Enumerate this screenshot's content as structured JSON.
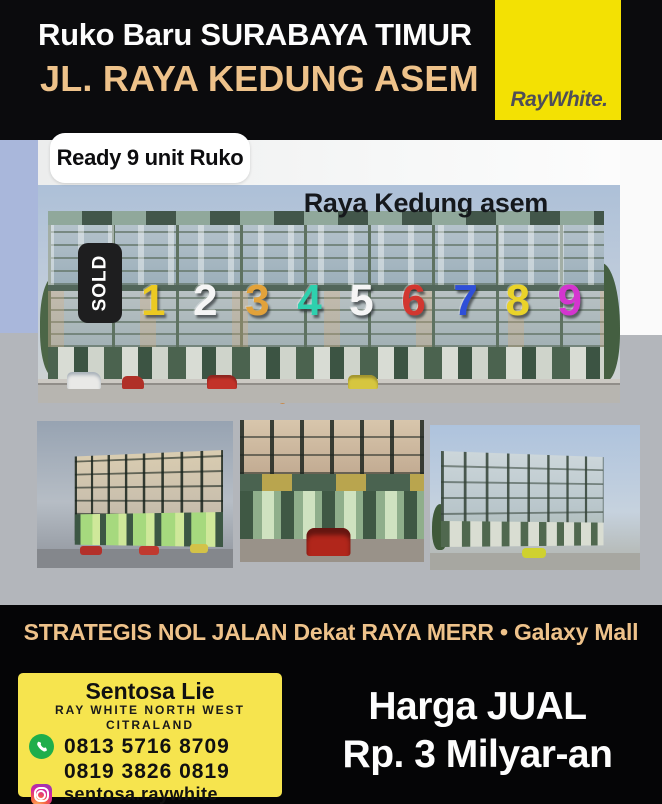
{
  "colors": {
    "accent_tan": "#eec28a",
    "brand_yellow": "#f3e103",
    "logo_text": "#4e4e58",
    "card_yellow": "#f6e44e",
    "whatsapp_green": "#1fae4b"
  },
  "header": {
    "title_line1": "Ruko Baru SURABAYA TIMUR",
    "title_line2": "JL. RAYA KEDUNG ASEM",
    "brand": "RayWhite."
  },
  "listing": {
    "ready_badge": "Ready 9 unit Ruko",
    "street_label": "Raya Kedung asem",
    "sold_badge": "SOLD",
    "unit_numbers": [
      {
        "label": "1",
        "color": "#ecca22"
      },
      {
        "label": "2",
        "color": "#f5f5f5"
      },
      {
        "label": "3",
        "color": "#e2a23a"
      },
      {
        "label": "4",
        "color": "#2ed0ae"
      },
      {
        "label": "5",
        "color": "#f5f5f5"
      },
      {
        "label": "6",
        "color": "#d23730"
      },
      {
        "label": "7",
        "color": "#2f4fd8"
      },
      {
        "label": "8",
        "color": "#ead32a"
      },
      {
        "label": "9",
        "color": "#d435cf"
      }
    ]
  },
  "tagline": "STRATEGIS NOL JALAN Dekat RAYA MERR • Galaxy Mall",
  "contact": {
    "agent_name": "Sentosa Lie",
    "office_line1": "RAY WHITE NORTH WEST",
    "office_line2": "CITRALAND",
    "phone1": "0813 5716 8709",
    "phone2": "0819 3826 0819",
    "instagram": "sentosa.raywhite"
  },
  "price": {
    "line1": "Harga JUAL",
    "line2": "Rp. 3 Milyar-an"
  }
}
